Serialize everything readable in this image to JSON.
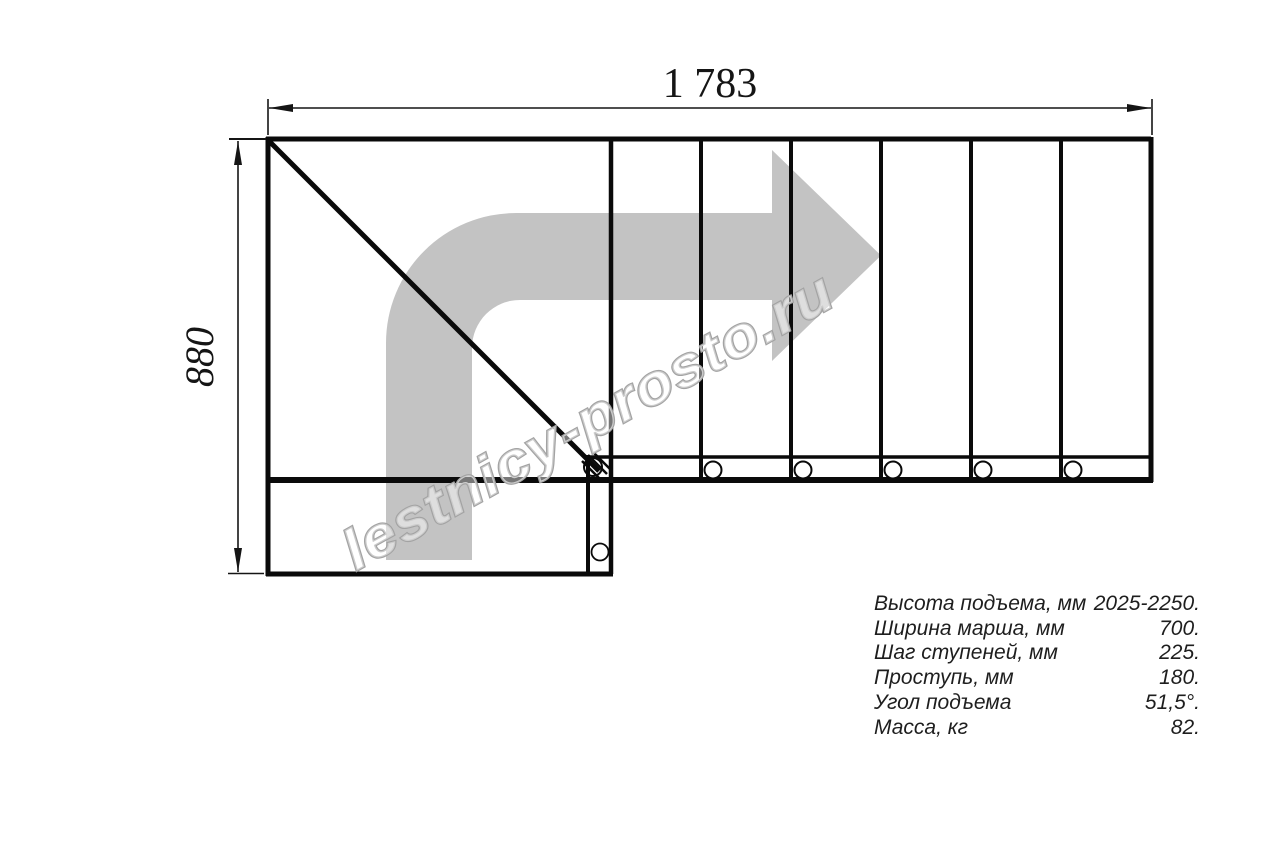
{
  "drawing": {
    "title": "stair-plan-top-view",
    "dim_width_label": "1 783",
    "dim_height_label": "880",
    "watermark_text": "lestnicy-prosto.ru",
    "colors": {
      "line": "#0a0a0a",
      "arrow_fill": "#c3c3c3",
      "watermark_stroke": "#a3a3a3",
      "dim_text": "#151515"
    }
  },
  "specs": {
    "rows": [
      {
        "label": "Высота подъема, мм",
        "value": "2025-2250."
      },
      {
        "label": "Ширина марша, мм",
        "value": "700."
      },
      {
        "label": "Шаг ступеней, мм",
        "value": "225."
      },
      {
        "label": "Проступь, мм",
        "value": "180."
      },
      {
        "label": "Угол подъема",
        "value": "51,5°."
      },
      {
        "label": "Масса, кг",
        "value": "82."
      }
    ]
  }
}
